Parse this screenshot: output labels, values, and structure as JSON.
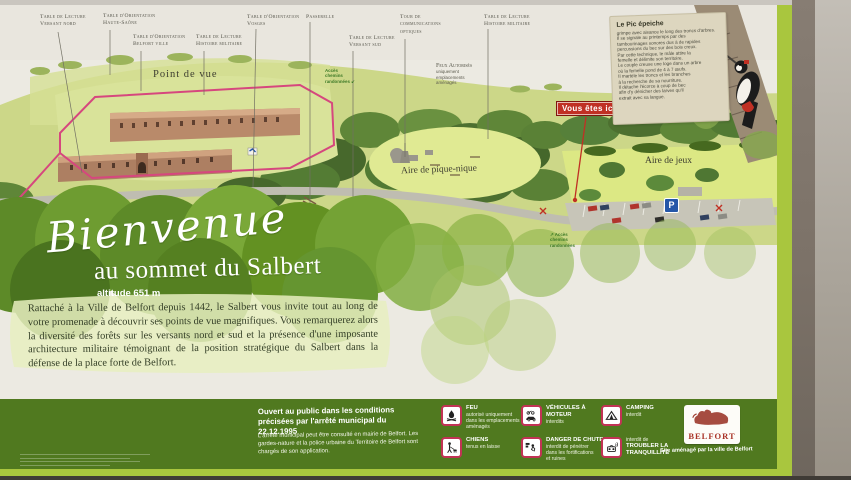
{
  "map": {
    "point_labels": [
      {
        "text": "Table de Lecture\nVersant nord"
      },
      {
        "text": "Table d'Orientation\nHaute-Saône"
      },
      {
        "text": "Table d'Orientation\nBelfort ville"
      },
      {
        "text": "Table de Lecture\nHistoire militaire"
      },
      {
        "text": "Table d'Orientation\nVosges"
      },
      {
        "text": "Passerelle"
      },
      {
        "text": "Table de Lecture\nVersant sud"
      },
      {
        "text": "Tour de\ncommunications\noptiques"
      },
      {
        "text": "Table de Lecture\nHistoire militaire"
      }
    ],
    "features": {
      "point_de_vue": "Point de vue",
      "aire_pique_nique": "Aire de pique-nique",
      "aire_de_jeux": "Aire de jeux",
      "acces_top": "Accès\nchemins\nrandonnées",
      "acces_bottom": "Accès\nchemins\nrandonnées",
      "feux_title": "Feux Autorisés",
      "feux_detail": "uniquement\nemplacements\naménagés",
      "parking_sign": "P",
      "you_are_here": "Vous êtes ici"
    },
    "nature_box": {
      "title": "Le Pic épeiche",
      "body": "grimpe avec aisance le long des troncs d'arbres.\nIl se signale au printemps par des\ntambourinages sonores dus à de rapides\npercussions du bec sur des bois creux.\nPar cette technique, le mâle attire la\nfemelle et délimite son territoire.\nLe couple creuse une loge dans un arbre\noù la femelle pond de 4 à 7 œufs.\nIl martèle les troncs et les branches\nà la recherche de sa nourriture.\nIl détache l'écorce à coup de bec\nafin d'y dénicher des larves qu'il\nextrait avec sa langue."
    }
  },
  "welcome": {
    "script_title": "Bienvenue",
    "subtitle": "au sommet du Salbert",
    "altitude": "altitude 651 m",
    "paragraph": "Rattaché à la Ville de Belfort depuis 1442, le Salbert vous invite tout au long de votre promenade à découvrir ses points de vue magnifiques. Vous remarquerez alors la diversité des forêts sur les versants nord et sud et la présence d'une imposante architecture militaire témoignant de la position stratégique du Salbert dans la défense de la place forte de Belfort."
  },
  "footer": {
    "opening_bold": "Ouvert au public dans les conditions précisées par l'arrêté municipal du 22.12.1995",
    "opening_small": "L'arrêté municipal peut être consulté en mairie de Belfort. Les gardes-nature et la police urbaine du Territoire de Belfort sont chargés de son application.",
    "rules": [
      {
        "icon": "fire-icon",
        "title": "FEU",
        "detail": "autorisé uniquement\ndans les emplacements\naménagés"
      },
      {
        "icon": "dog-icon",
        "title": "CHIENS",
        "detail": "tenus en laisse"
      },
      {
        "icon": "motor-vehicle-icon",
        "title": "VÉHICULES À MOTEUR",
        "detail": "interdits"
      },
      {
        "icon": "falling-icon",
        "title": "DANGER DE CHUTE",
        "detail": "interdit de pénétrer\ndans les fortifications\net ruines"
      },
      {
        "icon": "tent-icon",
        "title": "CAMPING",
        "detail": "interdit"
      },
      {
        "icon": "noise-icon",
        "pre": "interdit de",
        "title": "TROUBLER LA\nTRANQUILLITÉ",
        "detail": ""
      }
    ],
    "logo_word": "BELFORT",
    "logo_caption": "Site aménagé par la ville de Belfort"
  },
  "colors": {
    "footer_green": "#50791f",
    "frame_green": "#a9c63e",
    "badge_red": "#c03024",
    "trail_pink": "#d6477e",
    "parking_blue": "#2456a8",
    "logo_red": "#a93327"
  }
}
